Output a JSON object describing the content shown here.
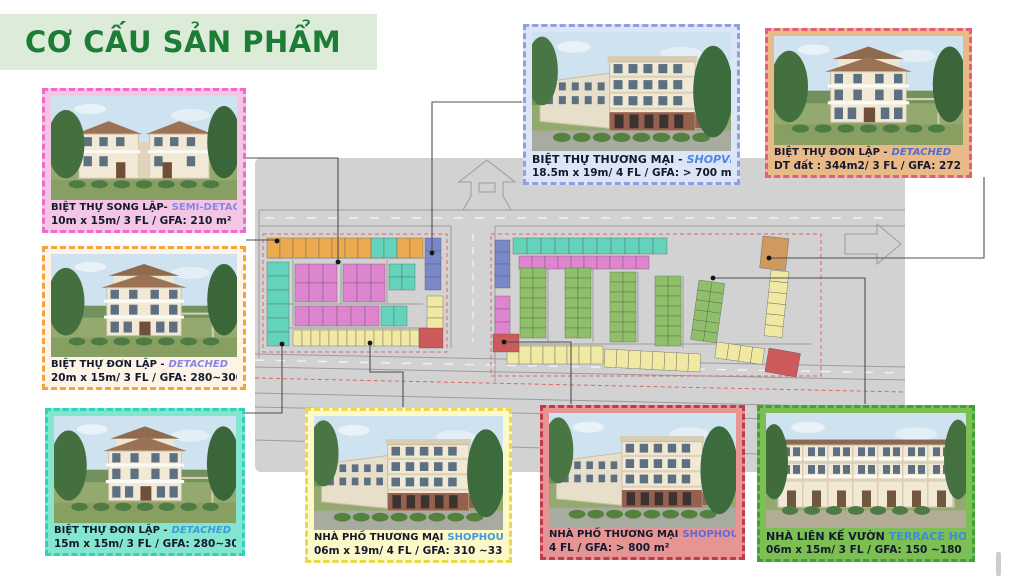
{
  "slide": {
    "title": "CƠ CẤU SẢN PHẨM"
  },
  "cards": [
    {
      "id": "semi-detached-villa",
      "name_vi": "BIỆT THỰ SONG LẬP-",
      "name_en": "SEMI-DETACHED",
      "specs": "10m x 15m/ 3 FL / GFA: 210 m²",
      "border": "#ef6cc8",
      "bg": "#f3c6e5",
      "en_color": "#8a85e8",
      "image": "semi-detached-villa-rendering",
      "variant": "semi"
    },
    {
      "id": "detached-villa-20x15",
      "name_vi": "BIỆT THỰ ĐƠN LẬP -",
      "name_en": "DETACHED",
      "specs": "20m x 15m/ 3 FL / GFA: 280~300 m²",
      "border": "#f2a33c",
      "bg": "#fdf4e7",
      "en_color": "#8a85e8",
      "image": "detached-villa-rendering",
      "variant": "villa"
    },
    {
      "id": "detached-villa-15x15",
      "name_vi": "BIỆT THỰ ĐƠN LẬP -",
      "name_en": "DETACHED",
      "specs": "15m x 15m/ 3 FL / GFA: 280~300 m²",
      "border": "#2fd2bd",
      "bg": "#85e6cf",
      "en_color": "#3d9ade",
      "image": "detached-villa-rendering",
      "variant": "villa"
    },
    {
      "id": "shopvilla",
      "name_vi": "BIỆT THỰ THƯƠNG MẠI -",
      "name_en": "SHOPVILLA",
      "specs": "18.5m x 19m/ 4 FL / GFA: > 700 m²",
      "border": "#8f9fe0",
      "bg": "#dde6f7",
      "en_color": "#4f86e0",
      "image": "shopvilla-rendering",
      "variant": "shoprow"
    },
    {
      "id": "detached-villa-344",
      "name_vi": "BIỆT THỰ ĐƠN LẬP -",
      "name_en": "DETACHED",
      "specs": "DT đất : 344m2/ 3 FL / GFA: 272 m²",
      "border": "#e55f7d",
      "bg": "#e9b988",
      "en_color": "#4f6fd0",
      "image": "detached-villa-rendering",
      "variant": "villa"
    },
    {
      "id": "shophouse-6x19",
      "name_vi": "NHÀ PHỐ THƯƠNG MẠI",
      "name_en": "SHOPHOUSE",
      "specs": "06m x 19m/ 4 FL / GFA: 310 ~330m²",
      "border": "#e9d94e",
      "bg": "#fcf8c8",
      "en_color": "#3d9ade",
      "image": "shophouse-rendering",
      "variant": "shoprow"
    },
    {
      "id": "shophouse-corner",
      "name_vi": "NHÀ PHỐ THƯƠNG MẠI",
      "name_en": "SHOPHOUSE",
      "specs": "4 FL / GFA: > 800 m²",
      "border": "#c23a4b",
      "bg": "#e79494",
      "en_color": "#5c6cd8",
      "image": "shophouse-rendering",
      "variant": "shoprow"
    },
    {
      "id": "terrace-house",
      "name_vi": "NHÀ LIÊN KẾ VƯỜN",
      "name_en": "TERRACE HOUSE",
      "specs": "06m x 15m/ 3 FL / GFA: 150 ~180 m²",
      "border": "#3da23d",
      "bg": "#7cbf52",
      "en_color": "#3d8ade",
      "image": "terrace-house-rendering",
      "variant": "terrace"
    }
  ],
  "map": {
    "description": "master-plan site map with colored product lots",
    "base_color": "#d2d2d2",
    "road_line_color": "#9c9c9c",
    "boundary_dash_color": "#e06565",
    "lot_colors": {
      "detached_orange": "#eda94e",
      "detached_teal": "#63d4bb",
      "semi_detached_pink": "#df85cf",
      "shopvilla_blue": "#7a88c8",
      "shophouse_yellow": "#f0e9a4",
      "terrace_green": "#8fc069",
      "shophouse_red": "#cd5a5a",
      "detached_tan": "#cf9a5f"
    }
  }
}
